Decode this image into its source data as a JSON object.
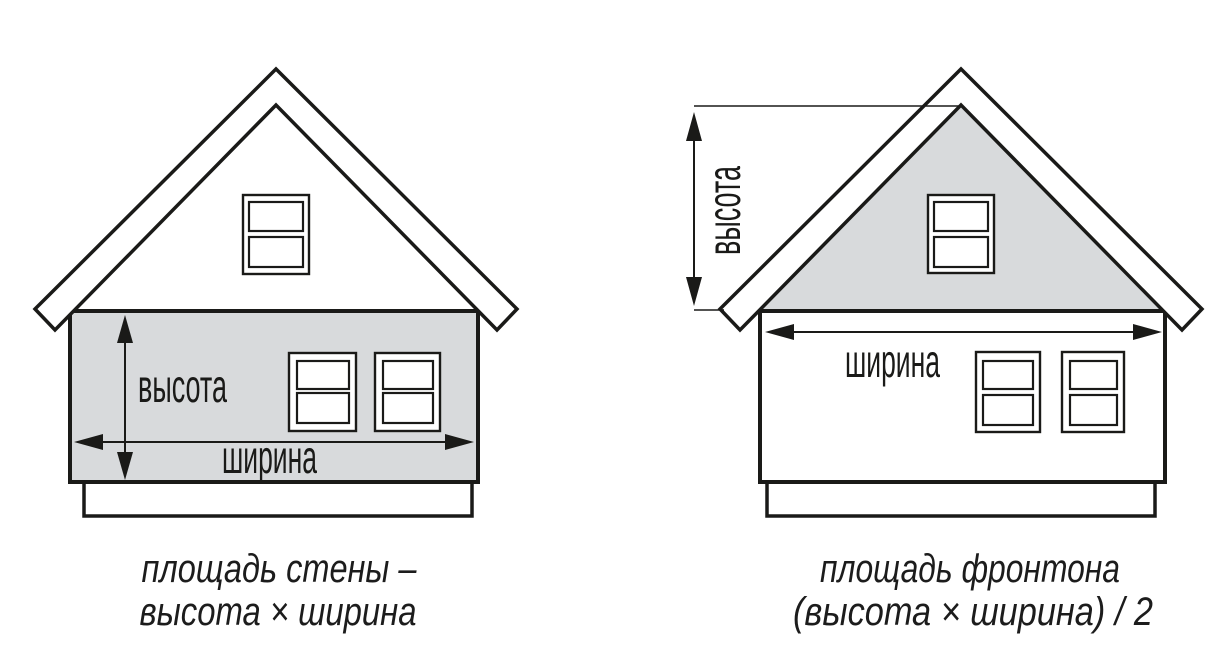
{
  "diagram": {
    "left_house": {
      "height_label": "высота",
      "width_label": "ширина",
      "caption_line1": "площадь стены –",
      "caption_line2": "высота × ширина"
    },
    "right_house": {
      "height_label": "высота",
      "width_label": "ширина",
      "caption_line1": "площадь фронтона",
      "caption_line2": "(высота × ширина) / 2"
    }
  },
  "colors": {
    "line": "#1a1a18",
    "shaded_area_fill": "#d8dadc",
    "background": "#ffffff",
    "caption_text": "#1c1c1c"
  }
}
